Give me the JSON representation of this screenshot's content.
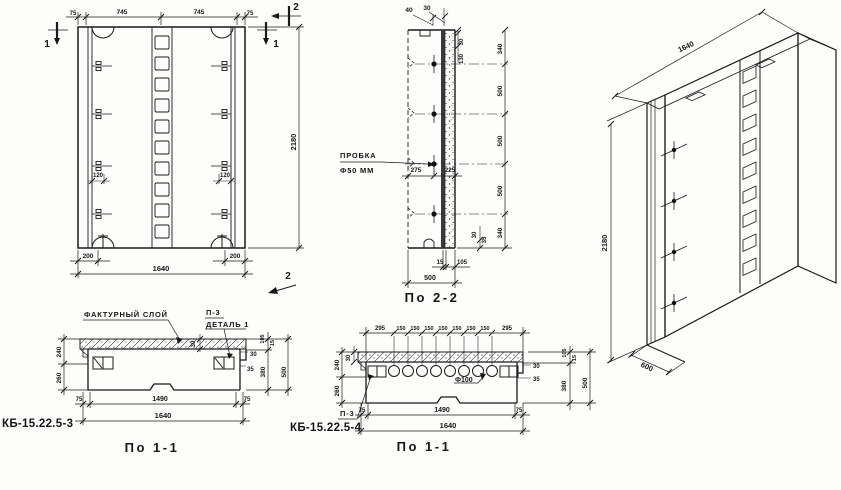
{
  "front": {
    "dims_top": [
      "75",
      "745",
      "745",
      "75"
    ],
    "mark_1_left": "1",
    "mark_1_right": "1",
    "mark_2_top": "2",
    "mark_2_bottom": "2",
    "dim_anchor_left": "120",
    "dim_anchor_right": "120",
    "dim_height": "2180",
    "dim_edge_left": "200",
    "dim_edge_right": "200",
    "dim_width": "1640"
  },
  "sec22": {
    "caption": "По 2-2",
    "plug_line1": "ПРОБКА",
    "plug_line2": "Ф50 ММ",
    "dim_top_40": "40",
    "dim_top_30": "30",
    "dim_rot_30": "30",
    "dim_rot_130": "130",
    "dim_275": "275",
    "dim_225": "225",
    "dims_right": [
      "340",
      "500",
      "500",
      "500",
      "340"
    ],
    "dim_bot_30": "30",
    "dim_bot_35": "35",
    "dim_15": "15",
    "dim_105": "105",
    "dim_500": "500"
  },
  "iso": {
    "dim_length": "1640",
    "dim_height": "2180",
    "dim_depth": "600"
  },
  "sec11a": {
    "mark": "КБ-15.22.5-3",
    "caption": "По 1-1",
    "label_texture": "ФАКТУРНЫЙ СЛОЙ",
    "label_p3": "П-3",
    "label_detail": "ДЕТАЛЬ 1",
    "dim_rot_30": "30",
    "dims_left": [
      "240",
      "260"
    ],
    "dim_r30": "30",
    "dim_r35": "35",
    "dims_col": [
      "105",
      "15",
      "380",
      "500"
    ],
    "dims_bottom": [
      "75",
      "1490",
      "75"
    ],
    "dim_width": "1640"
  },
  "sec11b": {
    "mark": "КБ-15.22.5-4",
    "caption": "По 1-1",
    "label_p3": "П-3",
    "label_hole": "Ф100",
    "dim_rot_30": "30",
    "dims_top": [
      "295",
      "150",
      "150",
      "150",
      "150",
      "150",
      "150",
      "150",
      "295"
    ],
    "dims_left": [
      "240",
      "260"
    ],
    "dim_r30": "30",
    "dim_r35": "35",
    "dims_col": [
      "105",
      "15",
      "380",
      "500"
    ],
    "dims_bottom": [
      "75",
      "1490",
      "75"
    ],
    "dim_width": "1640"
  }
}
